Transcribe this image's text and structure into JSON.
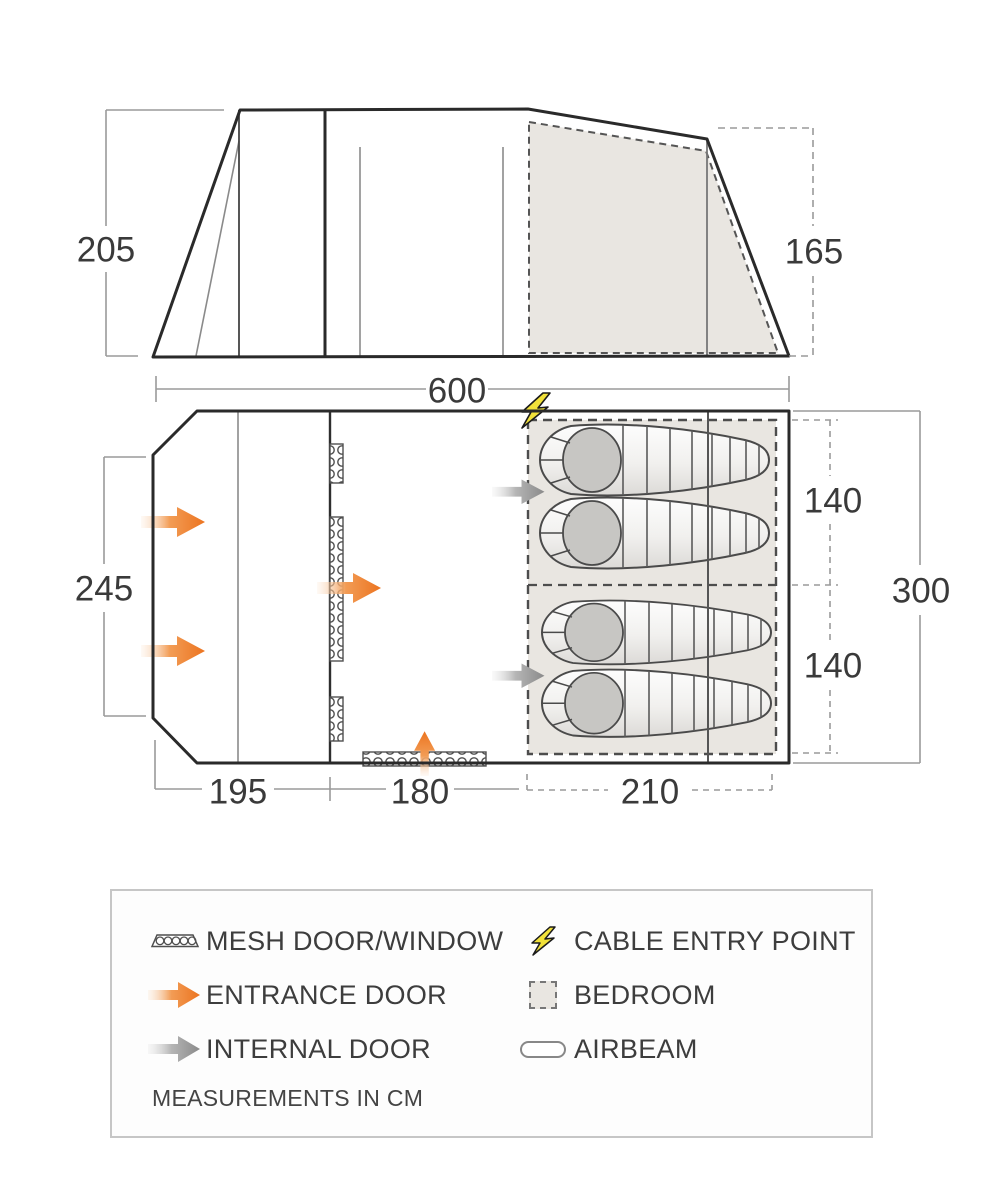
{
  "colors": {
    "outline": "#2a2a2a",
    "dimension_gray": "#9a9a9a",
    "bedroom_fill": "#e9e6e1",
    "accent_orange": "#ec7420",
    "internal_gray": "#8a8a8a",
    "bolt_yellow": "#f1e13a"
  },
  "elevation": {
    "left_height_cm": "205",
    "rear_height_cm": "165"
  },
  "floorplan": {
    "total_width_cm": "600",
    "front_depth_cm": "245",
    "total_depth_cm": "300",
    "bedroom_top_width_cm": "140",
    "bedroom_bottom_width_cm": "140",
    "porch_length_cm": "195",
    "living_length_cm": "180",
    "bedroom_length_cm": "210"
  },
  "legend": {
    "items": [
      {
        "icon": "mesh-icon",
        "label": "MESH DOOR/WINDOW"
      },
      {
        "icon": "cable-entry-icon",
        "label": "CABLE ENTRY POINT"
      },
      {
        "icon": "entrance-door-icon",
        "label": "ENTRANCE DOOR"
      },
      {
        "icon": "bedroom-icon",
        "label": "BEDROOM"
      },
      {
        "icon": "internal-door-icon",
        "label": "INTERNAL DOOR"
      },
      {
        "icon": "airbeam-icon",
        "label": "AIRBEAM"
      }
    ],
    "note": "MEASUREMENTS IN CM"
  }
}
